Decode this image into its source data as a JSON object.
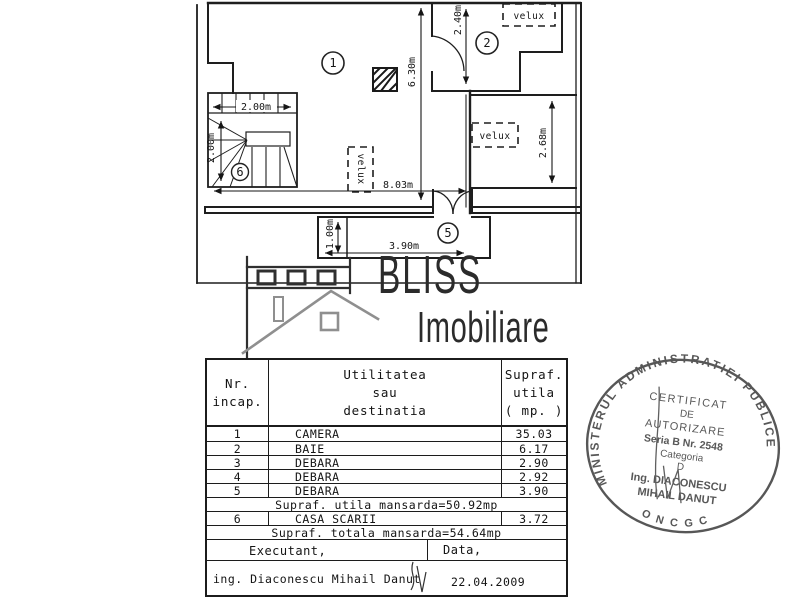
{
  "logo": {
    "brand": "BLISS",
    "subtitle": "Imobiliare"
  },
  "plan": {
    "velux": "velux",
    "room_labels": {
      "room1": "1",
      "room2": "2",
      "room5": "5",
      "room6": "6"
    },
    "dims": {
      "stair_width": "2.00m",
      "stair_depth": "2.00m",
      "room1_height": "6.30m",
      "room2_depth": "2.40m",
      "right_room_depth": "2.68m",
      "total_width": "8.03m",
      "balcony_width": "3.90m",
      "balcony_depth": "1.00m"
    }
  },
  "table": {
    "headers": {
      "col1": [
        "Nr.",
        "incap."
      ],
      "col2": [
        "Utilitatea",
        "sau",
        "destinatia"
      ],
      "col3": [
        "Supraf.",
        "utila",
        "( mp. )"
      ]
    },
    "rows": [
      {
        "nr": "1",
        "name": "CAMERA",
        "area": "35.03"
      },
      {
        "nr": "2",
        "name": "BAIE",
        "area": "6.17"
      },
      {
        "nr": "3",
        "name": "DEBARA",
        "area": "2.90"
      },
      {
        "nr": "4",
        "name": "DEBARA",
        "area": "2.92"
      },
      {
        "nr": "5",
        "name": "DEBARA",
        "area": "3.90"
      }
    ],
    "subtotal": "Supraf. utila mansarda=50.92mp",
    "row6": {
      "nr": "6",
      "name": "CASA SCARII",
      "area": "3.72"
    },
    "total": "Supraf. totala mansarda=54.64mp",
    "executant_label": "Executant,",
    "data_label": "Data,",
    "executant_name": "ing. Diaconescu Mihail Danut",
    "date": "22.04.2009"
  },
  "stamp": {
    "ring": "MINISTERUL ADMINISTRATIEI PUBLICE",
    "bottom": "O N C G C",
    "lines": [
      "CERTIFICAT",
      "DE",
      "AUTORIZARE",
      "Seria B Nr. 2548",
      "Categoria",
      "D",
      "Ing. DIACONESCU",
      "MIHAIL DANUT"
    ]
  }
}
